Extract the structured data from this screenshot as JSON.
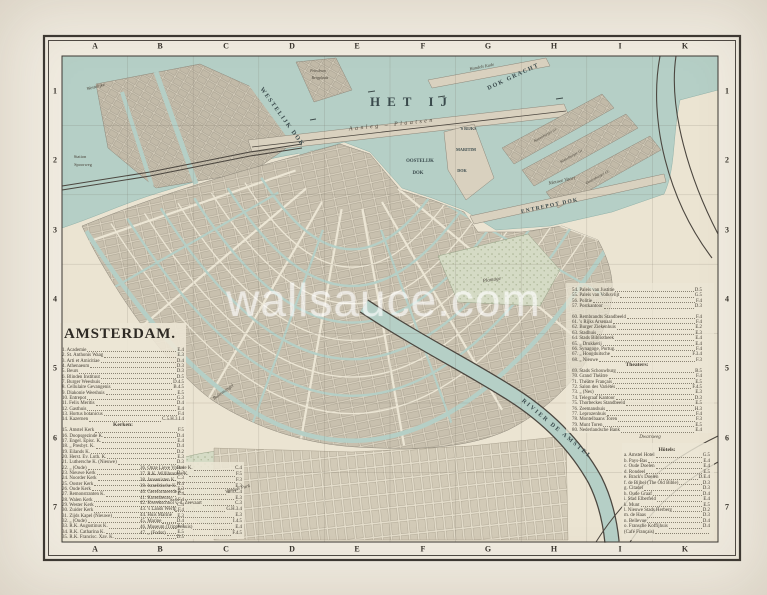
{
  "title": {
    "text": "AMSTERDAM."
  },
  "watermark": {
    "text": "wallsauce.com"
  },
  "colors": {
    "paper": "#ece6d5",
    "water": "#b5cfc6",
    "ink": "#3c3833",
    "block": "#c8c0ae",
    "park": "#d5dbc5",
    "watermark": "rgba(255,255,255,0.55)"
  },
  "grid": {
    "columns": [
      "A",
      "B",
      "C",
      "D",
      "E",
      "F",
      "G",
      "H",
      "I",
      "K"
    ],
    "rows": [
      "1",
      "2",
      "3",
      "4",
      "5",
      "6",
      "7"
    ],
    "col_x": [
      95,
      160,
      226,
      292,
      357,
      423,
      488,
      554,
      620,
      685
    ],
    "row_y": [
      91,
      160,
      230,
      299,
      368,
      438,
      507
    ],
    "top_y": 46,
    "bottom_y": 549,
    "left_x": 55,
    "right_x": 727
  },
  "map_labels": [
    {
      "t": "HET IJ",
      "x": 412,
      "y": 106,
      "s": 13,
      "ls": 7,
      "cls": "sc"
    },
    {
      "t": "Aanleg – Plaatsen",
      "x": 392,
      "y": 126,
      "r": -6,
      "s": 6,
      "ls": 2.5,
      "cls": "it"
    },
    {
      "t": "WESTELIJK DOK",
      "x": 281,
      "y": 118,
      "r": 54,
      "s": 6.2,
      "ls": 1.5,
      "cls": "sc"
    },
    {
      "t": "DOK GRACHT",
      "x": 514,
      "y": 78,
      "r": -25,
      "s": 6,
      "ls": 1.5,
      "cls": "sc"
    },
    {
      "t": "'S RIJKS",
      "x": 468,
      "y": 130,
      "s": 4.2,
      "cls": "sc"
    },
    {
      "t": "MARITIM",
      "x": 466,
      "y": 151,
      "s": 4.2,
      "cls": "sc"
    },
    {
      "t": "DOK",
      "x": 462,
      "y": 172,
      "s": 4.2,
      "cls": "sc"
    },
    {
      "t": "OOSTELIJK",
      "x": 420,
      "y": 162,
      "s": 4.8,
      "cls": "sc"
    },
    {
      "t": "DOK",
      "x": 418,
      "y": 174,
      "s": 4.8,
      "cls": "sc"
    },
    {
      "t": "Nieuwe Vaart",
      "x": 562,
      "y": 182,
      "r": -12,
      "s": 5,
      "cls": "it"
    },
    {
      "t": "ENTREPOT DOK",
      "x": 550,
      "y": 207,
      "r": -12,
      "s": 5.5,
      "ls": 1.2,
      "cls": "sc"
    },
    {
      "t": "Kattenburger Gr.",
      "x": 546,
      "y": 136,
      "r": -29,
      "s": 3.8,
      "cls": "it"
    },
    {
      "t": "Wittenburger Gr.",
      "x": 572,
      "y": 157,
      "r": -29,
      "s": 3.8,
      "cls": "it"
    },
    {
      "t": "Oostenburger Gr.",
      "x": 598,
      "y": 178,
      "r": -29,
      "s": 3.8,
      "cls": "it"
    },
    {
      "t": "Handels Kade",
      "x": 482,
      "y": 68,
      "r": -11,
      "s": 4.4,
      "cls": "it"
    },
    {
      "t": "Petroleum",
      "x": 318,
      "y": 72,
      "s": 3.8,
      "cls": "it"
    },
    {
      "t": "Bergplaats",
      "x": 320,
      "y": 79,
      "s": 3.8,
      "cls": "it"
    },
    {
      "t": "Westelijke",
      "x": 96,
      "y": 88,
      "r": -14,
      "s": 4.6,
      "cls": "it"
    },
    {
      "t": "Station",
      "x": 80,
      "y": 158,
      "s": 4.4,
      "cls": "rm"
    },
    {
      "t": "Spoorweg",
      "x": 83,
      "y": 166,
      "s": 4.4,
      "cls": "rm"
    },
    {
      "t": "RIVIER DE AMSTEL",
      "x": 556,
      "y": 430,
      "r": 40,
      "s": 6,
      "ls": 2,
      "cls": "sc"
    },
    {
      "t": "Buitensingel",
      "x": 224,
      "y": 393,
      "r": -35,
      "s": 4.8,
      "cls": "it"
    },
    {
      "t": "Plantage",
      "x": 492,
      "y": 281,
      "r": -8,
      "s": 5,
      "cls": "it"
    },
    {
      "t": "Vondels Park",
      "x": 238,
      "y": 490,
      "r": -14,
      "s": 4.8,
      "cls": "it"
    },
    {
      "t": "Dwarsweg",
      "x": 650,
      "y": 438,
      "s": 5,
      "cls": "it"
    }
  ],
  "legend_columns": [
    {
      "x": 62,
      "y": 348,
      "w": 122,
      "lh": 5.35,
      "entries": [
        {
          "t": "1. Academie",
          "loc": "E.4"
        },
        {
          "t": "2. St. Anthonis Waag",
          "loc": "E.3"
        },
        {
          "t": "3. Arti et Amicitiae",
          "loc": "D.4"
        },
        {
          "t": "4. Athenaeum",
          "loc": "D.3"
        },
        {
          "t": "5. Beurs",
          "loc": "D.3"
        },
        {
          "t": "6. Blinden Instituut",
          "loc": "D.5"
        },
        {
          "t": "7. Burger Weeshuis",
          "loc": "D.4.5"
        },
        {
          "t": "8. Cellulaire Gevangenis",
          "loc": "B.4.5"
        },
        {
          "t": "9. Diakonie Weeshuis",
          "loc": "E.5"
        },
        {
          "t": "10. Entrepot",
          "loc": "G.3"
        },
        {
          "t": "11. Felix Meritis",
          "loc": "D.4"
        },
        {
          "t": "12. Gasthuis",
          "loc": "E.4"
        },
        {
          "t": "13. Hortus botanicus",
          "loc": "F.4"
        },
        {
          "t": "14. Kazernen",
          "loc": "C.5.H.3.I.4"
        },
        {
          "h": "Kerken:"
        },
        {
          "t": "15. Amstel Kerk",
          "loc": "F.5"
        },
        {
          "t": "16. Doopsgezinde K.",
          "loc": "D.4"
        },
        {
          "t": "17. Engel. Episc. K.",
          "loc": "E.4"
        },
        {
          "t": "18. „ Presbyt. K.",
          "loc": "D.4"
        },
        {
          "t": "19. Eilands K.",
          "loc": "D.2"
        },
        {
          "t": "20. Herst. Ev. Luth. K.",
          "loc": "E.3"
        },
        {
          "t": "21. Luthersche K. (Nieuwe)",
          "loc": "D.3"
        },
        {
          "t": "22. „ (Oude)",
          "loc": "D.4"
        },
        {
          "t": "23. Nieuwe Kerk",
          "loc": "D.3"
        },
        {
          "t": "24. Noorder Kerk",
          "loc": "C.3"
        },
        {
          "t": "25. Ooster Kerk",
          "loc": "H.4"
        },
        {
          "t": "26. Oude Kerk",
          "loc": "E.3"
        },
        {
          "t": "27. Remonstranten K.",
          "loc": "E.4"
        },
        {
          "t": "28. Walen Kerk",
          "loc": "E.4.F.4"
        },
        {
          "t": "29. Wester Kerk",
          "loc": "C.4"
        },
        {
          "t": "30. Zuider Kerk",
          "loc": "E.F.4"
        },
        {
          "t": "31. Zijds Kapel (Nieuwe)",
          "loc": "E.3"
        },
        {
          "t": "32. „ (Oude)",
          "loc": "D.4"
        },
        {
          "t": "33. R.K. Augustinus K.",
          "loc": "E.4"
        },
        {
          "t": "34. R.K. Catharina K.",
          "loc": "E.5"
        },
        {
          "t": "35. R.K. Francisc. Xav. K.",
          "loc": "D.5"
        }
      ]
    },
    {
      "x": 140,
      "y": 466,
      "w": 102,
      "lh": 5.9,
      "entries": [
        {
          "t": "36. Onze Lieve Vrouwe K.",
          "loc": "C.4"
        },
        {
          "t": "37. R.K. Willibrordus K.",
          "loc": "F.5"
        },
        {
          "t": "38. Jansenisten K.",
          "loc": "F.3"
        },
        {
          "t": "39. Israelitische K.",
          "loc": "E.3"
        },
        {
          "t": "40. Gereformeerde K.",
          "loc": "E.3.C.4"
        },
        {
          "t": "41. Korenbeurs",
          "loc": "E.3"
        },
        {
          "t": "42. Kweekschool v. d. Zeevaart",
          "loc": "C.3"
        },
        {
          "t": "43. 's Lands Werf",
          "loc": "G.H.3.4"
        },
        {
          "t": "44. Huis Marine",
          "loc": "E.3"
        },
        {
          "t": "45. Marine",
          "loc": "I.4.5"
        },
        {
          "t": "46. Museum (Trippenhuis)",
          "loc": "E.4"
        },
        {
          "t": "47. „ (Fodor)",
          "loc": "F.4.5"
        }
      ]
    },
    {
      "x": 572,
      "y": 288,
      "w": 130,
      "lh": 5.4,
      "entries": [
        {
          "t": "54. Paleis van Justitie",
          "loc": "D.5"
        },
        {
          "t": "55. Paleis van Volksvlijt",
          "loc": "G.5"
        },
        {
          "t": "56. Politie",
          "loc": "F.4"
        },
        {
          "t": "57. Postkantoor",
          "loc": "D.3"
        },
        {
          "sp": true
        },
        {
          "t": "60. Rembrandts Standbeeld",
          "loc": "F.4"
        },
        {
          "t": "61. 's Rijks Arsenaal",
          "loc": "F.4"
        },
        {
          "t": "62. Burger Ziekenhuis",
          "loc": "E.2"
        },
        {
          "t": "63. Stadhuis",
          "loc": "E.3"
        },
        {
          "t": "64. Stads Bibliotheek",
          "loc": "E.4"
        },
        {
          "t": "65. „ Drukkerij",
          "loc": "E.4"
        },
        {
          "t": "66. Synagoge, Portug.",
          "loc": "F.4"
        },
        {
          "t": "67. „ Hoogduitsche",
          "loc": "F.3.4"
        },
        {
          "t": "68. „ Nieuwe",
          "loc": "F.3"
        },
        {
          "h": "Theaters:"
        },
        {
          "t": "69. Stads Schouwburg",
          "loc": "B.5"
        },
        {
          "t": "70. Grand Théâtre",
          "loc": "F.4"
        },
        {
          "t": "71. Théâtre Français",
          "loc": "E.5"
        },
        {
          "t": "72. Salon des Variétés",
          "loc": "F.4.5"
        },
        {
          "t": "73. „ (Nes)",
          "loc": "E.3"
        },
        {
          "t": "74. Telegraaf Kantoor",
          "loc": "D.3"
        },
        {
          "t": "75. Thorbeckes Standbeeld",
          "loc": "E.5"
        },
        {
          "t": "76. Zeemanshuis",
          "loc": "H.3"
        },
        {
          "t": "77. Leprozenhuis",
          "loc": "F.4"
        },
        {
          "t": "78. Montelbaans Toren",
          "loc": "F.3"
        },
        {
          "t": "79. Munt Toren",
          "loc": "E.5"
        },
        {
          "t": "80. Nederlandsche Bank",
          "loc": "E.4"
        }
      ]
    },
    {
      "x": 624,
      "y": 448,
      "w": 86,
      "lh": 5.45,
      "entries": [
        {
          "h": "Hôtels:"
        },
        {
          "t": "a. Amstel Hotel",
          "loc": "G.5"
        },
        {
          "t": "b. Pays-Bas",
          "loc": "E.4"
        },
        {
          "t": "c. Oude Doelen",
          "loc": "E.4"
        },
        {
          "t": "d. Rondeel",
          "loc": "E.5"
        },
        {
          "t": "e. Brack's Doelen",
          "loc": "D.E.4"
        },
        {
          "t": "f. de Bijbel (The Old Bible)",
          "loc": "D.3"
        },
        {
          "t": "g. Citadel",
          "loc": "D.3"
        },
        {
          "t": "h. Oude Graaf",
          "loc": "D.4"
        },
        {
          "t": "i. Stad Elberfeld",
          "loc": "E.4"
        },
        {
          "t": "k. Munt",
          "loc": "E.5"
        },
        {
          "t": "l. Nieuwe Stads Herberg",
          "loc": "D.2"
        },
        {
          "t": "m. de Haas",
          "loc": "D.3"
        },
        {
          "t": "n. Bellevue",
          "loc": "D.4"
        },
        {
          "t": "o. Fransche Koffijhuis",
          "loc": "D.4"
        },
        {
          "t": "    (Café Français)",
          "loc": ""
        }
      ]
    }
  ]
}
